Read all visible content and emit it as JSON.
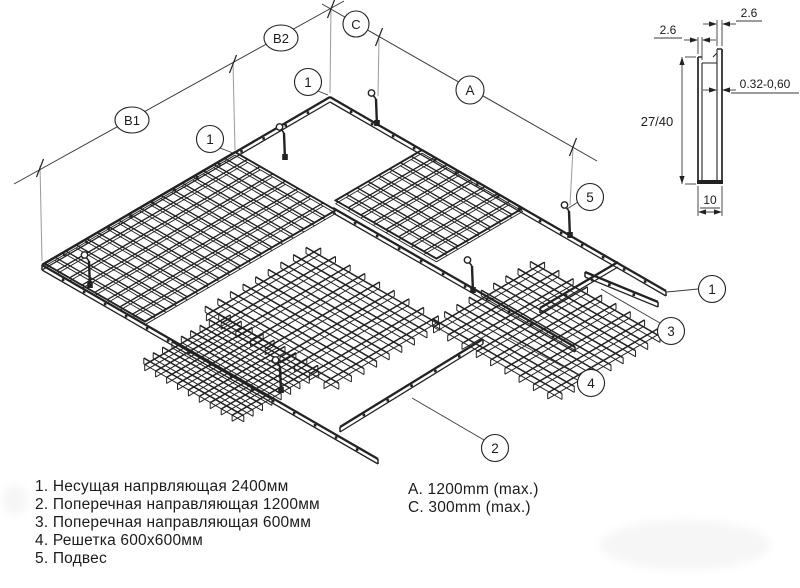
{
  "drawing_title": "Suspended grid ceiling assembly diagram",
  "colors": {
    "ink": "#222222",
    "thin": "#3a3a3a",
    "extension": "#9a9a9a",
    "paper": "#ffffff"
  },
  "dim_labels": {
    "b1": "B1",
    "b2": "B2",
    "c": "C",
    "a": "A"
  },
  "callouts": {
    "north_corner": "1",
    "top_left_rail": "1",
    "hanger_right": "5",
    "rail_end_right": "1",
    "cross_600": "3",
    "panel": "4",
    "cross_1200": "2"
  },
  "section": {
    "dim_top_left": "2.6",
    "dim_top_right": "2.6",
    "dim_thickness": "0.32-0,60",
    "dim_height": "27/40",
    "dim_width": "10"
  },
  "legend": {
    "items": [
      "1. Несущая напрвляющая 2400мм",
      "2. Поперечная направляющая 1200мм",
      "3. Поперечная направляющая 600мм",
      "4. Решетка 600х600мм",
      "5. Подвес"
    ],
    "notes": [
      "A. 1200mm (max.)",
      "C. 300mm (max.)"
    ]
  }
}
